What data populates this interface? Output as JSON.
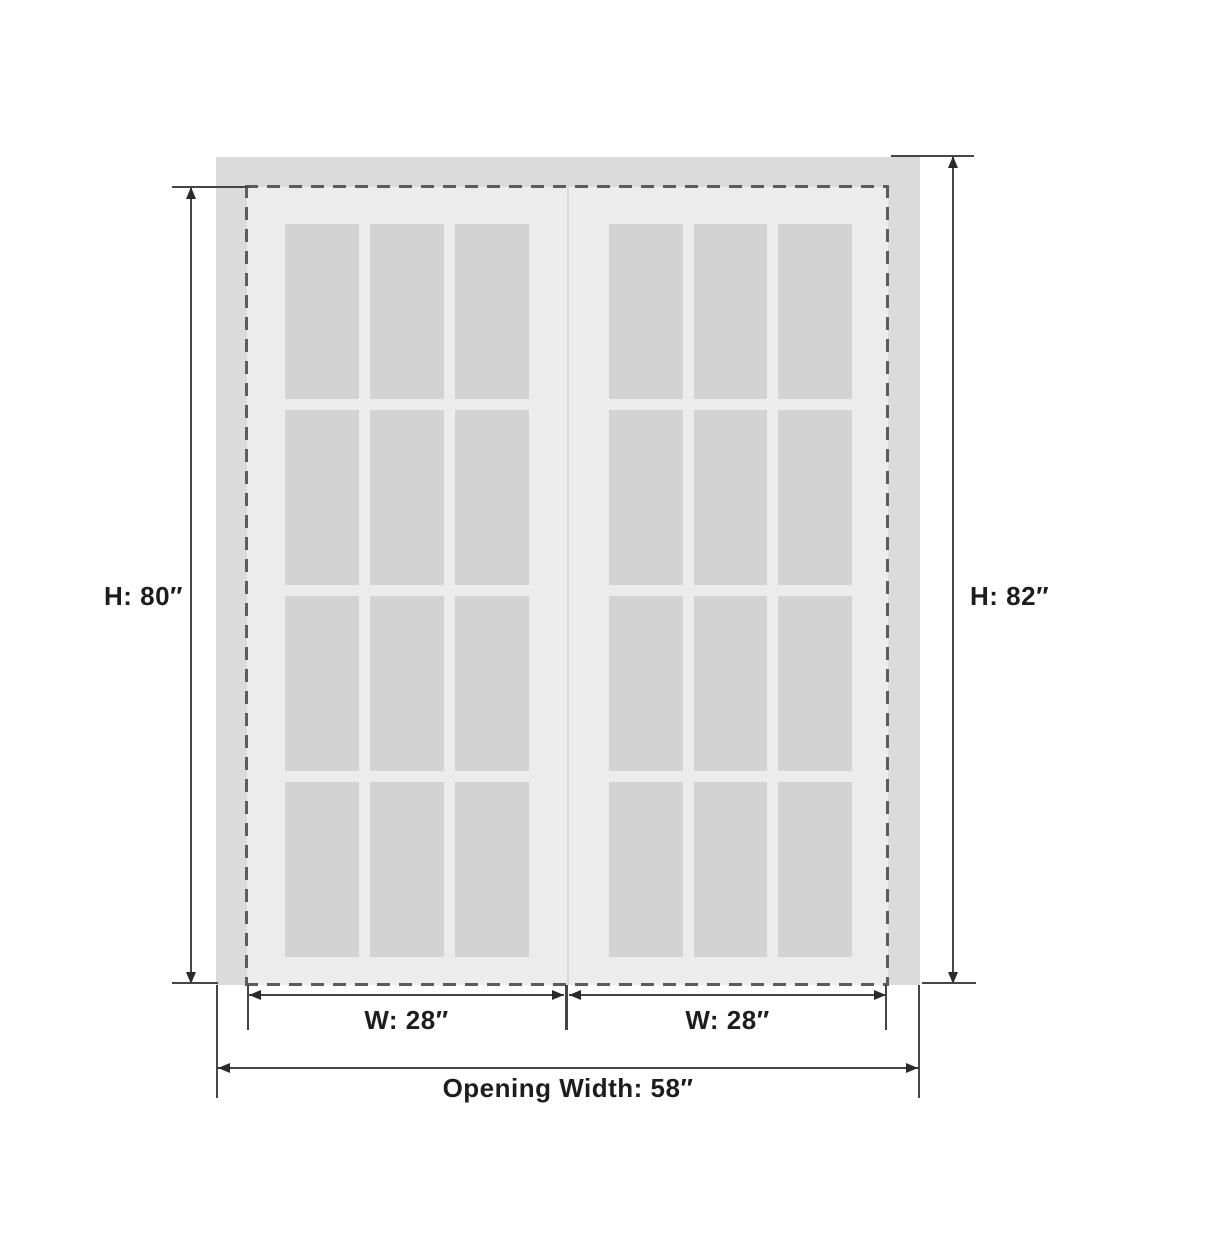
{
  "labels": {
    "door_height": "H: 80″",
    "opening_height": "H: 82″",
    "door_left_width": "W: 28″",
    "door_right_width": "W: 28″",
    "opening_width": "Opening Width: 58″"
  },
  "structure": {
    "door_count": 2,
    "pane_rows": 4,
    "pane_cols": 3
  },
  "colors": {
    "background": "#ffffff",
    "frame": "#dbdbdb",
    "door_face": "#ececec",
    "glass_pane": "#d3d3d3",
    "door_divider": "#d8d8d8",
    "dashed_outline": "#5c5c5c",
    "dimension_line": "#454545",
    "arrow": "#2b2b2b",
    "label_text": "#1d1d1d"
  }
}
